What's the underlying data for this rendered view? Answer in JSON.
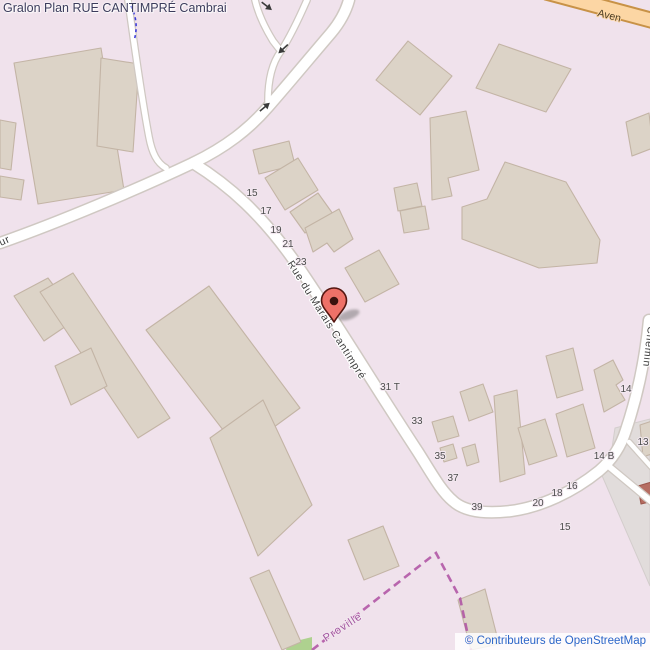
{
  "map": {
    "title": "Gralon Plan RUE CANTIMPRÉ Cambrai",
    "attribution": "© Contributeurs de OpenStreetMap",
    "streets": {
      "main": "Rue du Marais Cantimpré",
      "chemin": "Chemin",
      "avenue_partial": "Aven",
      "left_edge_partial": "ur",
      "boundary_place": "Proville"
    },
    "house_numbers": [
      {
        "text": "15"
      },
      {
        "text": "17"
      },
      {
        "text": "19"
      },
      {
        "text": "21"
      },
      {
        "text": "23"
      },
      {
        "text": "31 T"
      },
      {
        "text": "33"
      },
      {
        "text": "35"
      },
      {
        "text": "37"
      },
      {
        "text": "39"
      },
      {
        "text": "20"
      },
      {
        "text": "18"
      },
      {
        "text": "16"
      },
      {
        "text": "15"
      },
      {
        "text": "14 B"
      },
      {
        "text": "14"
      },
      {
        "text": "13"
      }
    ],
    "marker": {
      "name": "location-pin"
    },
    "colors": {
      "background": "#f0e2ec",
      "building": "#dcd3c7",
      "building_outline": "#c3b4a5",
      "road_fill": "#ffffff",
      "road_casing": "#cfc8c2",
      "primary_road_fill": "#fcd6a4",
      "primary_road_casing": "#c89247",
      "boundary": "#ae4fa2",
      "cycleway": "#3d3dd9",
      "landuse_gray": "#e1dcdb",
      "landuse_green": "#aed18f",
      "marker_fill": "#ee7168",
      "attribution_link": "#2b65c8",
      "title_text": "#3c3c5c"
    }
  }
}
